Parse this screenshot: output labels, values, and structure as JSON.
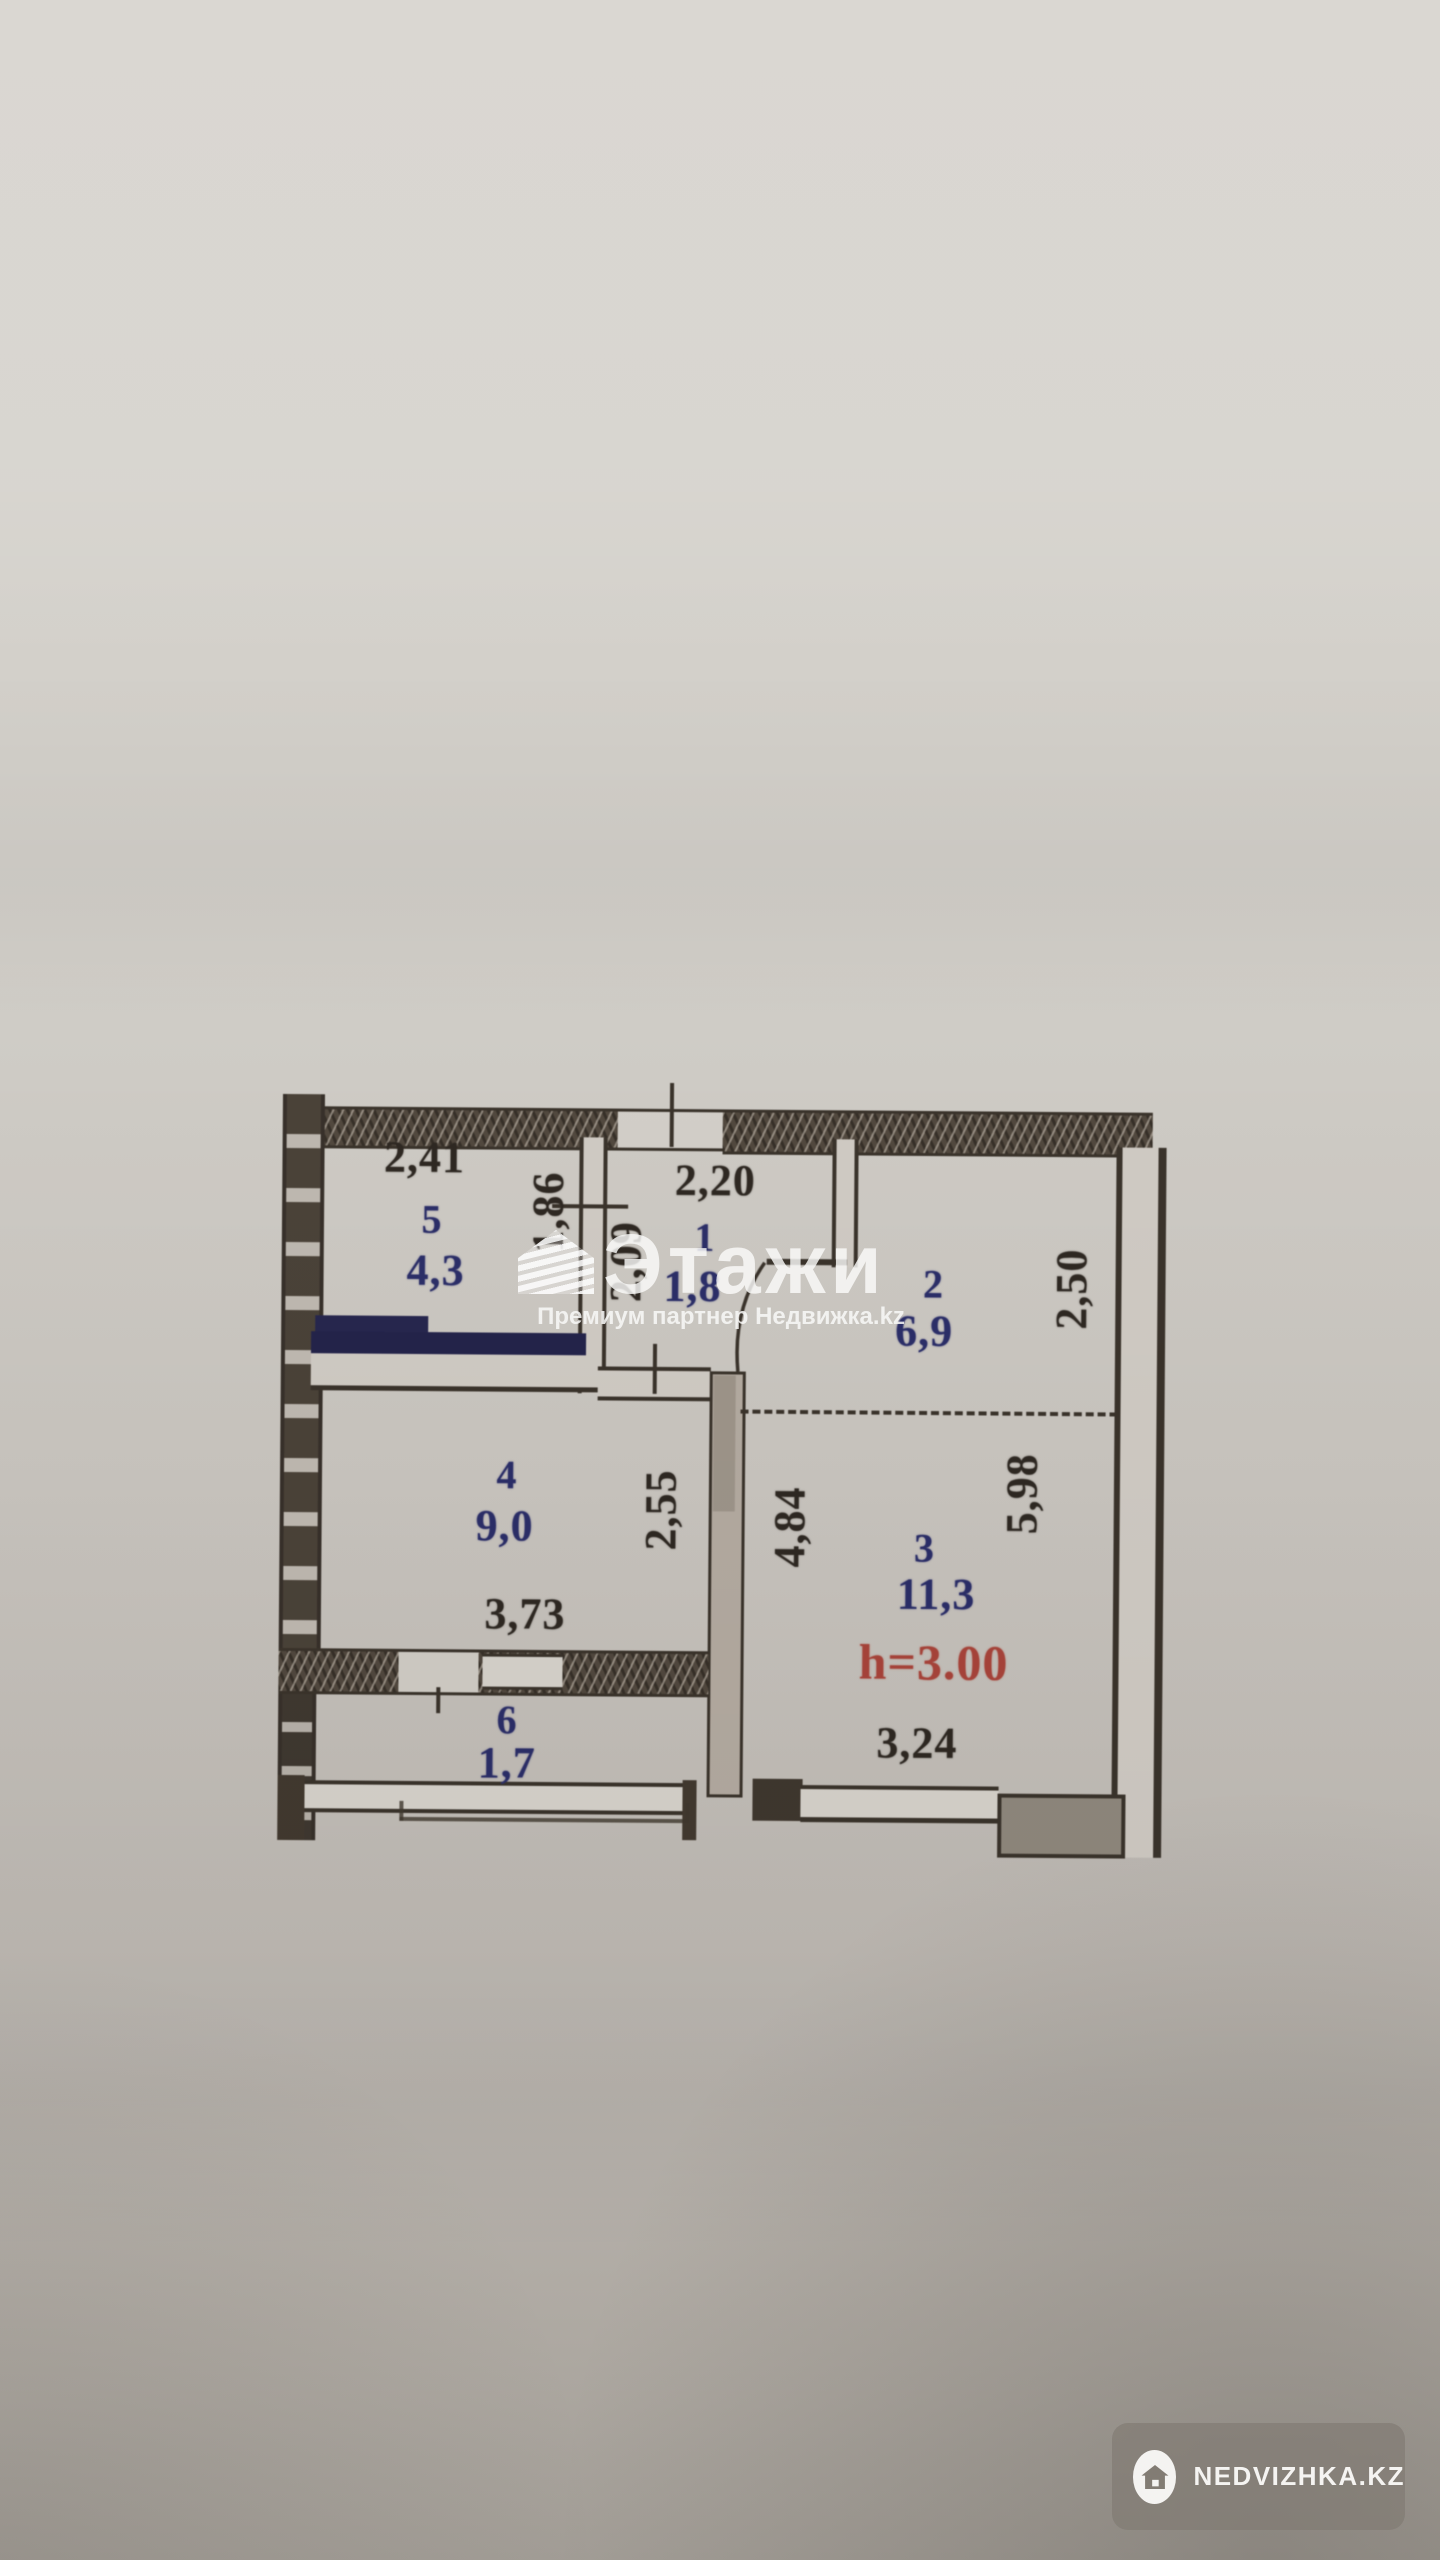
{
  "floor_plan": {
    "rooms": [
      {
        "number": "5",
        "area": "4,3"
      },
      {
        "number": "1",
        "area": "1,8"
      },
      {
        "number": "2",
        "area": "6,9"
      },
      {
        "number": "4",
        "area": "9,0"
      },
      {
        "number": "3",
        "area": "11,3"
      },
      {
        "number": "6",
        "area": "1,7"
      }
    ],
    "dims": {
      "room5_width": "2,41",
      "room1_width": "2,20",
      "hall_wall_upper": "1,86",
      "room1_depth": "2,09",
      "room2_depth": "2,50",
      "room4_depth": "2,55",
      "room3_left_depth": "4,84",
      "room3_right_depth": "5,98",
      "room4_width": "3,73",
      "room3_width": "3,24",
      "ceiling_height": "h=3.00"
    },
    "colors": {
      "wall_ink": "#3a332b",
      "room_label_ink": "#2b2e68",
      "dimension_ink": "#2e2822",
      "height_ink": "#a8443a",
      "marker_navy": "#23234a",
      "paper": "#cdc9c2"
    }
  },
  "watermark_center": {
    "brand": "Этажи",
    "subtitle": "Премиум партнер Недвижка.kz",
    "logo_icon": "etazhi-house-icon"
  },
  "watermark_badge": {
    "text": "NEDVIZHKA.KZ",
    "icon": "house-icon"
  }
}
